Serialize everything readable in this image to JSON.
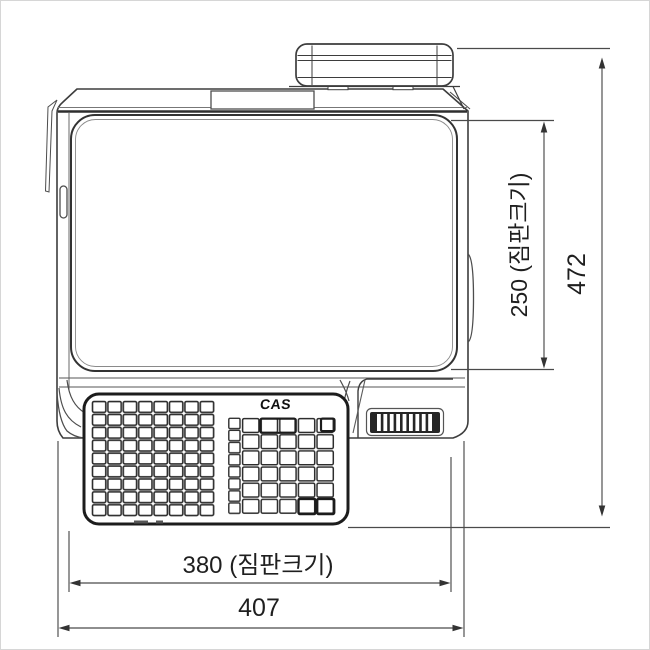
{
  "drawing": {
    "brand_logo": "CAS",
    "dim_platter_depth": "250 (짐판크기)",
    "dim_overall_depth": "472",
    "dim_platter_width": "380 (짐판크기)",
    "dim_overall_width": "407"
  },
  "colors": {
    "body_line": "#3d3d3d",
    "panel_line": "#1c1c1c",
    "dimension_line": "#4a4a4a",
    "text": "#1f1f1f",
    "background": "#ffffff"
  }
}
